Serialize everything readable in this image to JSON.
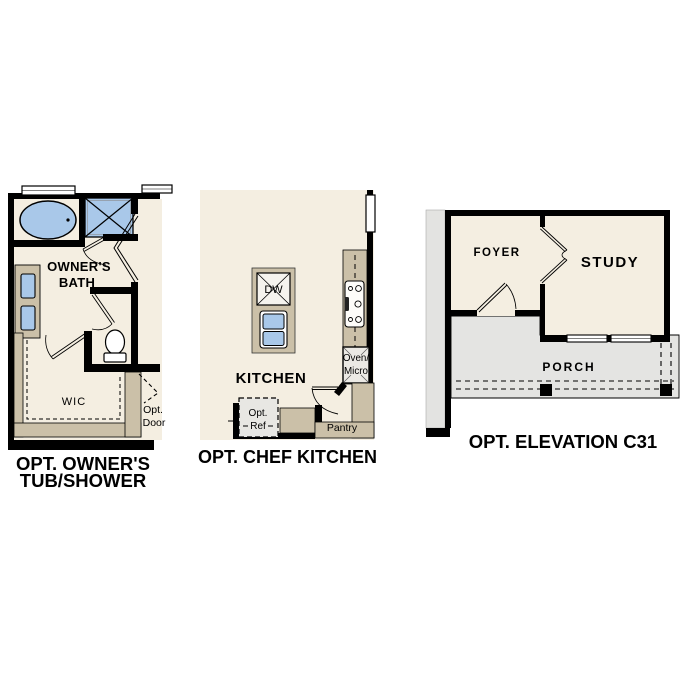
{
  "page": {
    "background": "#ffffff"
  },
  "colors": {
    "floor_cream": "#f4eee1",
    "wall_black": "#000000",
    "cabinet_tan": "#cbc0a8",
    "fixture_blue": "#a9c8e9",
    "porch_gray": "#e4e4e2",
    "appliance_gray": "#ebe9e4"
  },
  "plans": {
    "tub_shower": {
      "caption_line1": "OPT. OWNER'S",
      "caption_line2": "TUB/SHOWER",
      "room_label_line1": "OWNER'S",
      "room_label_line2": "BATH",
      "wic_label": "WIC",
      "opt_door_line1": "Opt.",
      "opt_door_line2": "Door"
    },
    "chef_kitchen": {
      "caption": "OPT. CHEF KITCHEN",
      "kitchen_label": "KITCHEN",
      "dw_label": "DW",
      "oven_line1": "Oven/",
      "oven_line2": "Micro",
      "ref_line1": "Opt.",
      "ref_line2": "Ref",
      "pantry_label": "Pantry"
    },
    "elevation": {
      "caption": "OPT. ELEVATION C31",
      "foyer_label": "FOYER",
      "study_label": "STUDY",
      "porch_label": "PORCH"
    }
  }
}
